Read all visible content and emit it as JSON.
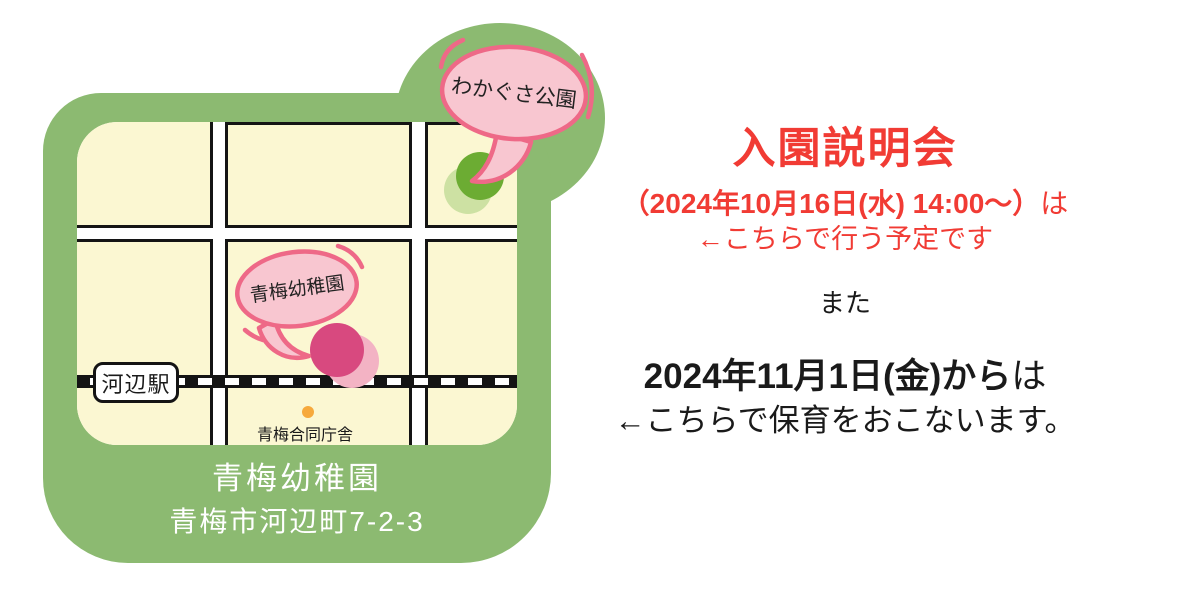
{
  "map_card": {
    "park_bubble_label": "わかぐさ公園",
    "kindergarten_bubble_label": "青梅幼稚園",
    "station_label": "河辺駅",
    "gov_office_label": "青梅合同庁舎",
    "footer": {
      "name": "青梅幼稚園",
      "address": "青梅市河辺町7-2-3"
    }
  },
  "announcement": {
    "title": "入園説明会",
    "session_date": "（2024年10月16日(水) 14:00〜）",
    "session_date_suffix": "は",
    "session_note": "←こちらで行う予定です",
    "connector": "また",
    "start_date": "2024年11月1日(金)から",
    "start_date_suffix": "は",
    "start_note": "←こちらで保育をおこないます。"
  },
  "colors": {
    "frame-green": "#8CBA71",
    "block-cream": "#FBF7D2",
    "outline-ink": "#141414",
    "bubble-fill": "#F8C6D0",
    "bubble-stroke": "#EE6987",
    "park-dot": "#6CAC33",
    "park-dot-shadow": "#CDE1A3",
    "kinder-dot": "#D8497F",
    "kinder-dot-shadow": "#F3B3C4",
    "gov-dot": "#F6A93C",
    "accent-red": "#F13B34",
    "text-black": "#1A1A1A"
  }
}
